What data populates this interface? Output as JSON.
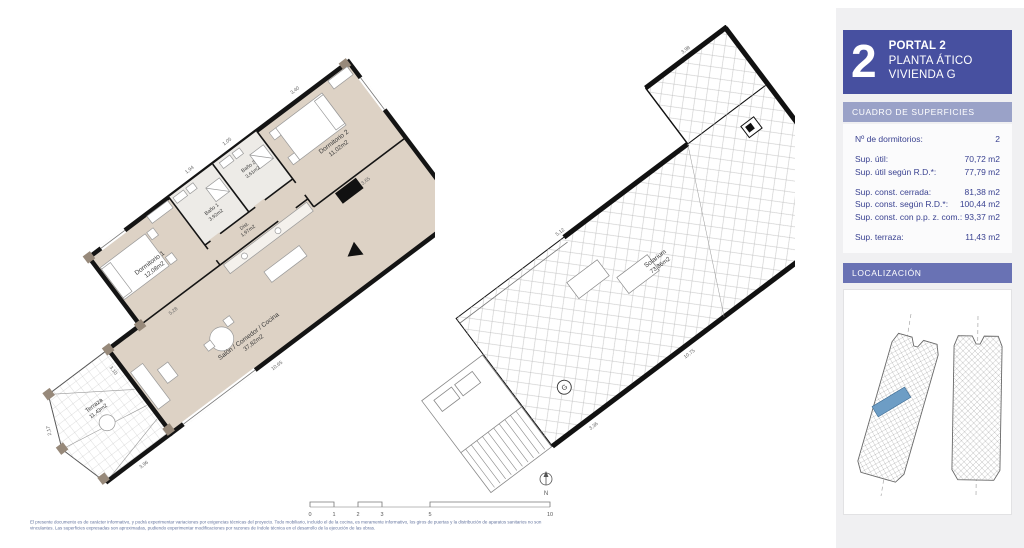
{
  "colors": {
    "accent_header": "#4750a0",
    "surfaces_bar": "#9aa2c8",
    "localization_bar": "#6972b4",
    "panel_background": "#f0f0f2",
    "floor_fill": "#ddd2c5",
    "highlight_unit": "#6d9dc5"
  },
  "panel": {
    "portal_numeral": "2",
    "title_lines": [
      "PORTAL 2",
      "PLANTA ÁTICO",
      "VIVIENDA G"
    ],
    "surfaces_header": "CUADRO DE SUPERFICIES",
    "rows": [
      {
        "label": "Nº de dormitorios:",
        "value": "2"
      },
      {
        "label": "Sup. útil:",
        "value": "70,72 m2"
      },
      {
        "label": "Sup. útil según R.D.*:",
        "value": "77,79 m2"
      },
      {
        "label": "Sup. const. cerrada:",
        "value": "81,38 m2"
      },
      {
        "label": "Sup. const. según R.D.*:",
        "value": "100,44 m2"
      },
      {
        "label": "Sup. const. con p.p. z. com.:",
        "value": "93,37 m2"
      },
      {
        "label": "Sup. terraza:",
        "value": "11,43 m2"
      }
    ],
    "localization_header": "LOCALIZACIÓN"
  },
  "plan_floor": {
    "rooms": {
      "dormitorio1": {
        "label": "Dormitorio 1",
        "area": "12,08m2"
      },
      "dormitorio2": {
        "label": "Dormitorio 2",
        "area": "11,02m2"
      },
      "bano1": {
        "label": "Baño 1",
        "area": "3,92m2"
      },
      "bano2": {
        "label": "Baño 2",
        "area": "3,61m2"
      },
      "dist": {
        "label": "Dist.",
        "area": "1,97m2"
      },
      "salon": {
        "label": "Salón / Comedor / Cocina",
        "area": "37,82m2"
      },
      "terraza": {
        "label": "Terraza",
        "area": "11,43m2"
      }
    },
    "dimensions": [
      "3,40",
      "1,05",
      "3,65",
      "5,28",
      "3,10",
      "10,65",
      "3,96",
      "2,17",
      "1,94"
    ]
  },
  "plan_roof": {
    "room": {
      "label": "Solarium",
      "area": "73,86m2"
    },
    "stair_badge": "G",
    "dimensions": [
      "5,12",
      "3,98",
      "10,75",
      "3,36"
    ]
  },
  "scale_bar": {
    "labels": [
      "0",
      "1",
      "2",
      "3",
      "5",
      "10"
    ]
  },
  "north": {
    "label": "N"
  },
  "footer": {
    "line1": "El presente documento es de carácter informativo, y podrá experimentar variaciones por exigencias técnicas del proyecto. Todo mobiliario, incluido el de la cocina, es meramente informativo, los giros de puertas y la distribución de aparatos sanitarios no son",
    "line2": "vinculantes. Las superficies expresadas son aproximadas, pudiendo experimentar modificaciones por razones de índole técnica en el desarrollo de la ejecución de las obras."
  }
}
